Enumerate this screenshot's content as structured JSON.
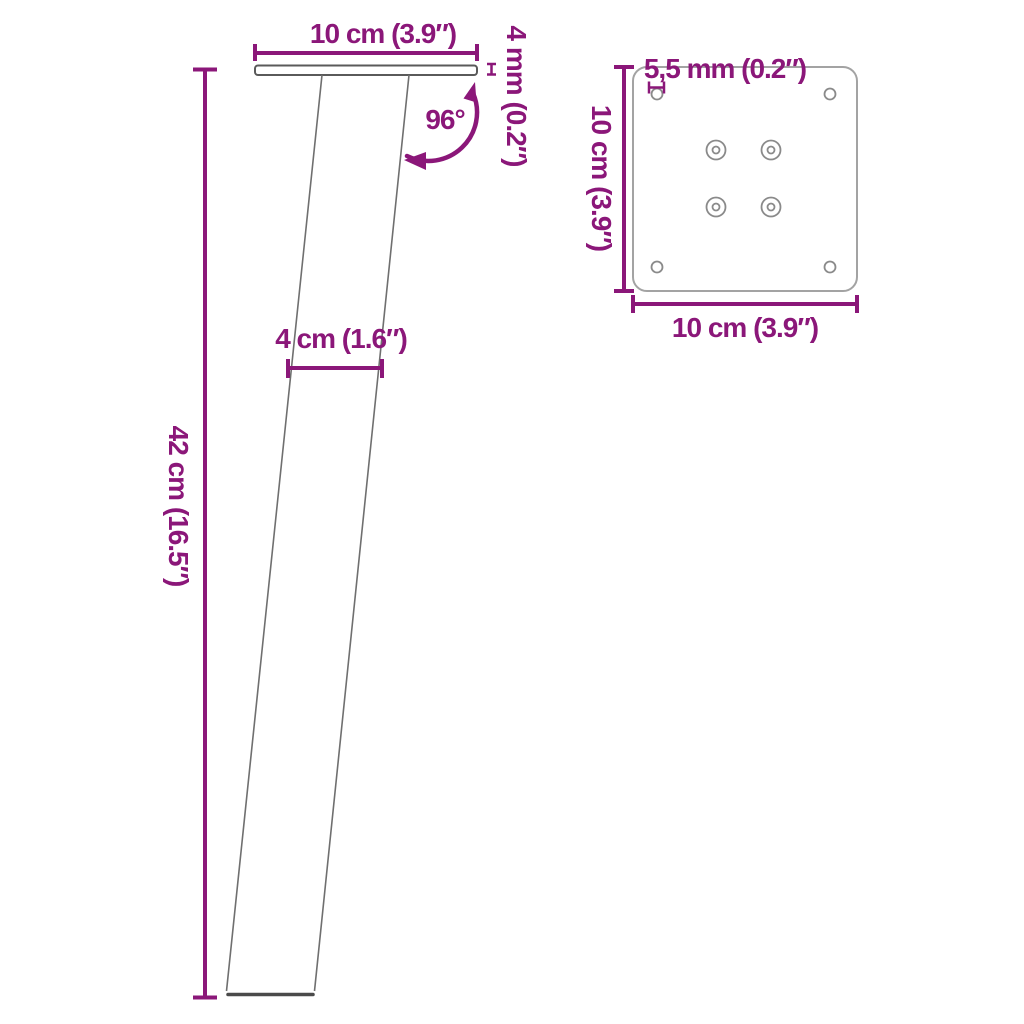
{
  "figure": {
    "type": "product-dimension-diagram",
    "subject": "angled furniture leg with mounting plate",
    "views": {
      "side_view": {
        "height": "42 cm (16.5″)",
        "top_width": "10 cm (3.9″)",
        "plate_thickness": "4 mm (0.2″)",
        "angle": "96°",
        "leg_width": "4 cm (1.6″)"
      },
      "top_view": {
        "hole_diameter": "5,5 mm (0.2″)",
        "depth": "10 cm (3.9″)",
        "width": "10 cm (3.9″)"
      }
    }
  },
  "colors": {
    "dimension": "#8B1779",
    "leg-outline": "#6f6f6f",
    "foot-outline": "#4a4a4a",
    "plate-outline": "#5a5a5a",
    "topview-outline": "#a3a3a3",
    "hole-outline": "#8a8a8a",
    "background": "#ffffff"
  }
}
